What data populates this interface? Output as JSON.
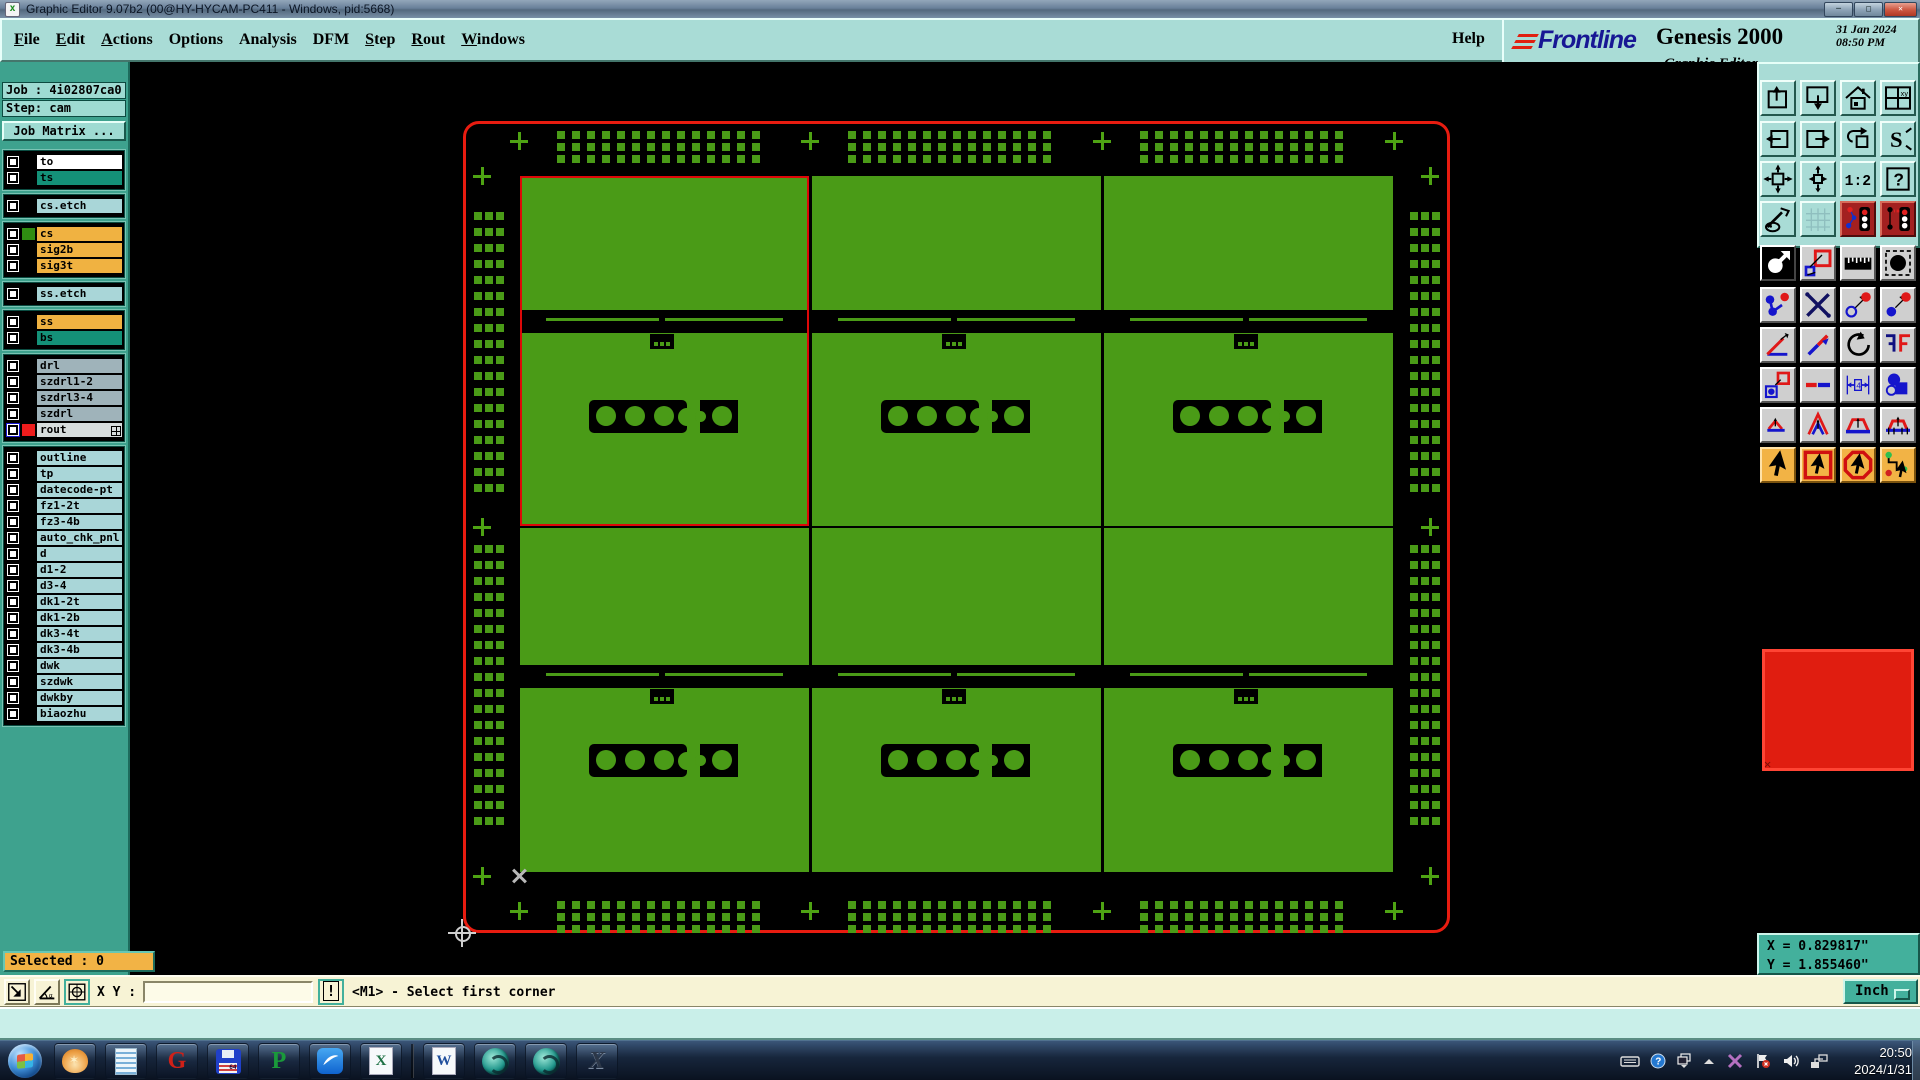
{
  "window": {
    "title": "Graphic Editor 9.07b2 (00@HY-HYCAM-PC411 - Windows, pid:5668)",
    "controls": {
      "minimize": "-",
      "maximize": "o",
      "close": "x"
    }
  },
  "menu": {
    "items": [
      {
        "label": "File",
        "u": 0
      },
      {
        "label": "Edit",
        "u": 0
      },
      {
        "label": "Actions",
        "u": 0
      },
      {
        "label": "Options",
        "u": -1
      },
      {
        "label": "Analysis",
        "u": -1
      },
      {
        "label": "DFM",
        "u": -1
      },
      {
        "label": "Step",
        "u": 0
      },
      {
        "label": "Rout",
        "u": 0
      },
      {
        "label": "Windows",
        "u": 0
      }
    ],
    "help": "Help"
  },
  "brand": {
    "name": "Frontline",
    "product": "Genesis 2000",
    "date": "31 Jan 2024",
    "time": "08:50 PM",
    "subtitle": "Graphic Editor"
  },
  "job": {
    "job_label": "Job :",
    "job_value": "4i02807ca0",
    "step_label": "Step:",
    "step_value": "cam",
    "matrix_button": "Job Matrix ..."
  },
  "layers": {
    "groups": [
      {
        "rows": [
          {
            "name": "to",
            "bg": "#ffffff"
          },
          {
            "name": "ts",
            "bg": "#149178"
          }
        ]
      },
      {
        "rows": [
          {
            "name": "cs.etch",
            "bg": "#a9d6d8"
          }
        ]
      },
      {
        "rows": [
          {
            "name": "cs",
            "bg": "#f0b241",
            "swatch": "#2f8d12"
          },
          {
            "name": "sig2b",
            "bg": "#f0b241"
          },
          {
            "name": "sig3t",
            "bg": "#f0b241"
          }
        ]
      },
      {
        "rows": [
          {
            "name": "ss.etch",
            "bg": "#a9d6d8"
          }
        ]
      },
      {
        "rows": [
          {
            "name": "ss",
            "bg": "#f0b241"
          },
          {
            "name": "bs",
            "bg": "#149178"
          }
        ]
      },
      {
        "rows": [
          {
            "name": "drl",
            "bg": "#9fb3ba"
          },
          {
            "name": "szdrl1-2",
            "bg": "#9fb3ba"
          },
          {
            "name": "szdrl3-4",
            "bg": "#9fb3ba"
          },
          {
            "name": "szdrl",
            "bg": "#9fb3ba"
          },
          {
            "name": "rout",
            "bg": "#d7dddd",
            "swatch": "#ee1c1c",
            "cb": "#1717cf",
            "grid": true
          }
        ]
      },
      {
        "rows": [
          {
            "name": "outline",
            "bg": "#a9d6d8"
          },
          {
            "name": "tp",
            "bg": "#a9d6d8"
          },
          {
            "name": "datecode-pt",
            "bg": "#a9d6d8"
          },
          {
            "name": "fz1-2t",
            "bg": "#a9d6d8"
          },
          {
            "name": "fz3-4b",
            "bg": "#a9d6d8"
          },
          {
            "name": "auto_chk_pnl",
            "bg": "#a9d6d8"
          },
          {
            "name": "d",
            "bg": "#a9d6d8"
          },
          {
            "name": "d1-2",
            "bg": "#a9d6d8"
          },
          {
            "name": "d3-4",
            "bg": "#a9d6d8"
          },
          {
            "name": "dk1-2t",
            "bg": "#a9d6d8"
          },
          {
            "name": "dk1-2b",
            "bg": "#a9d6d8"
          },
          {
            "name": "dk3-4t",
            "bg": "#a9d6d8"
          },
          {
            "name": "dk3-4b",
            "bg": "#a9d6d8"
          },
          {
            "name": "dwk",
            "bg": "#a9d6d8"
          },
          {
            "name": "szdwk",
            "bg": "#a9d6d8"
          },
          {
            "name": "dwkby",
            "bg": "#a9d6d8"
          },
          {
            "name": "biaozhu",
            "bg": "#a9d6d8"
          }
        ]
      }
    ]
  },
  "toolbar": {
    "rows": [
      {
        "style": "cyan",
        "buttons": [
          "import-board",
          "screen-down",
          "home-view",
          "window-xy"
        ]
      },
      {
        "style": "cyan",
        "buttons": [
          "exit-left",
          "exit-right",
          "undo-view",
          "s-step"
        ]
      },
      {
        "style": "cyan",
        "buttons": [
          "fit-view",
          "pan-view",
          "scale-1-2",
          "help-query"
        ]
      },
      {
        "style": "cyan",
        "buttons": [
          "setup-tools",
          "grid-toggle",
          "stoplight-a",
          "stoplight-b"
        ]
      },
      {
        "style": "gray",
        "buttons": [
          "zoom-area",
          "reshape",
          "ruler",
          "pad-dashed"
        ]
      },
      {
        "style": "gray",
        "buttons": [
          "nets",
          "net-delete",
          "open-pad-move",
          "filled-pad-move"
        ]
      },
      {
        "style": "gray",
        "buttons": [
          "angle-measure",
          "line-slash",
          "rotate-cw",
          "mirror-f"
        ]
      },
      {
        "style": "gray",
        "buttons": [
          "pad-copy",
          "stretch-dash",
          "measure-width",
          "shape-boolean"
        ]
      },
      {
        "style": "gray",
        "buttons": [
          "peak-low",
          "peak-high",
          "peak-flat",
          "peak-marked"
        ]
      },
      {
        "style": "orange",
        "buttons": [
          "select-cursor",
          "select-frame",
          "select-octagon",
          "select-net"
        ]
      }
    ]
  },
  "coords": {
    "x_line": "X = 0.829817\"",
    "y_line": "Y = 1.855460\""
  },
  "status": {
    "selected": "Selected : 0",
    "icons": [
      "resize-box",
      "angle-snap",
      "grid-snap"
    ],
    "xy_label": "X Y :",
    "input_value": "",
    "bang": "!",
    "prompt": "<M1> - Select first corner",
    "unit": "Inch"
  },
  "taskbar": {
    "apps": [
      "shell",
      "notepad",
      "genesis",
      "floppy",
      "paragon",
      "bluebird",
      "excel",
      "word",
      "camtek-1",
      "camtek-2",
      "xtools"
    ],
    "tray": [
      "keyboard",
      "help",
      "restore",
      "caret-up",
      "xsplit",
      "flag",
      "volume",
      "network"
    ],
    "clock_time": "20:50",
    "clock_date": "2024/1/31"
  },
  "canvas": {
    "board_color": "#4a9b17",
    "outline_color": "#e81c10",
    "border": {
      "x": 463,
      "y": 121,
      "w": 987,
      "h": 812,
      "radius": 16,
      "stroke": 3
    },
    "selection": {
      "x": 520,
      "y": 176,
      "w": 289,
      "h": 350,
      "color": "#dd0808"
    },
    "fiducial": {
      "size": 8,
      "top": {
        "y": 131,
        "rows": 3,
        "py": 12,
        "cols": 14,
        "px": 15,
        "xs": [
          557,
          848,
          1140
        ]
      },
      "bottom": {
        "y": 901,
        "rows": 3,
        "py": 12,
        "cols": 14,
        "px": 15,
        "xs": [
          557,
          848,
          1140
        ]
      },
      "left": {
        "x": 474,
        "cols": 3,
        "px": 11,
        "rows": 18,
        "py": 16,
        "ys": [
          212,
          545
        ]
      },
      "right": {
        "x": 1410,
        "cols": 3,
        "px": 11,
        "rows": 18,
        "py": 16,
        "ys": [
          212,
          545
        ]
      }
    },
    "plus_points": [
      [
        519,
        141
      ],
      [
        810,
        141
      ],
      [
        1102,
        141
      ],
      [
        1394,
        141
      ],
      [
        519,
        911
      ],
      [
        810,
        911
      ],
      [
        1102,
        911
      ],
      [
        1394,
        911
      ],
      [
        482,
        176
      ],
      [
        482,
        527
      ],
      [
        482,
        876
      ],
      [
        1430,
        176
      ],
      [
        1430,
        527
      ],
      [
        1430,
        876
      ]
    ],
    "cells": {
      "xs": [
        520,
        812,
        1104
      ],
      "w": 289,
      "rows": [
        {
          "top_y": 176,
          "top_h": 134,
          "ch_y": 310,
          "bot_y": 333,
          "bot_h": 193,
          "bar_y": 400
        },
        {
          "top_y": 528,
          "top_h": 137,
          "ch_y": 665,
          "bot_y": 688,
          "bot_h": 184,
          "bar_y": 744
        }
      ]
    },
    "channel": {
      "b1": 8,
      "slit": 3,
      "b2": 12,
      "cap_w": 26
    },
    "bar": {
      "dx": 69,
      "w": 98,
      "h": 33,
      "circles": [
        86,
        115,
        144
      ],
      "r": 10,
      "sq_dx": 180,
      "sq_w": 38,
      "sq_circle": 202
    },
    "tab": {
      "dx": 130,
      "w": 24,
      "h": 15
    },
    "x_mark": {
      "x": 519,
      "y": 876
    },
    "cursor": {
      "x": 462,
      "y": 933,
      "r": 7,
      "arm": 14
    }
  }
}
